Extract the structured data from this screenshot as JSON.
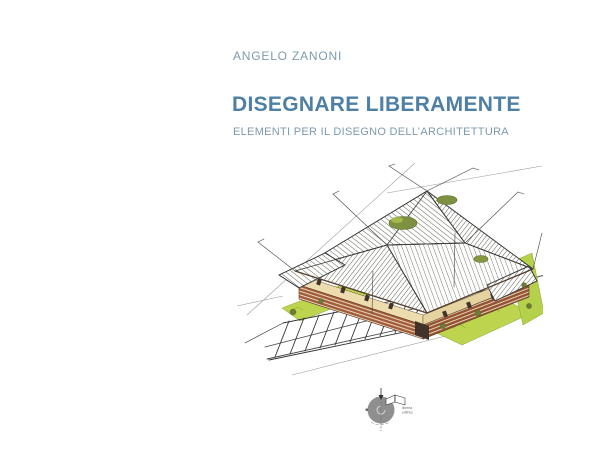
{
  "cover": {
    "author": "ANGELO ZANONI",
    "title": "DISEGNARE LIBERAMENTE",
    "subtitle": "ELEMENTI PER IL DISEGNO DELL’ARCHITETTURA",
    "colors": {
      "title_blue": "#4e80a6",
      "author_subtitle_blue": "#7d9aae",
      "background": "#ffffff"
    }
  },
  "illustration": {
    "description": "Hand-drawn axonometric architectural sketch: brick building complex with hatched hip roofs, thin masts, rooftop greenery, bright green lawns and a diagonal parking lot in the foreground",
    "colors": {
      "ink": "#3c3c3c",
      "brick": "#a35c38",
      "cream_wall": "#ecdcae",
      "lawn_green": "#bcd44e",
      "olive_green": "#7e9140",
      "faint_line": "#9a9a9a"
    }
  },
  "publisher_logo": {
    "text_line1": "libreria",
    "text_line2": "editrice",
    "circle_color": "#8f8f8f"
  }
}
